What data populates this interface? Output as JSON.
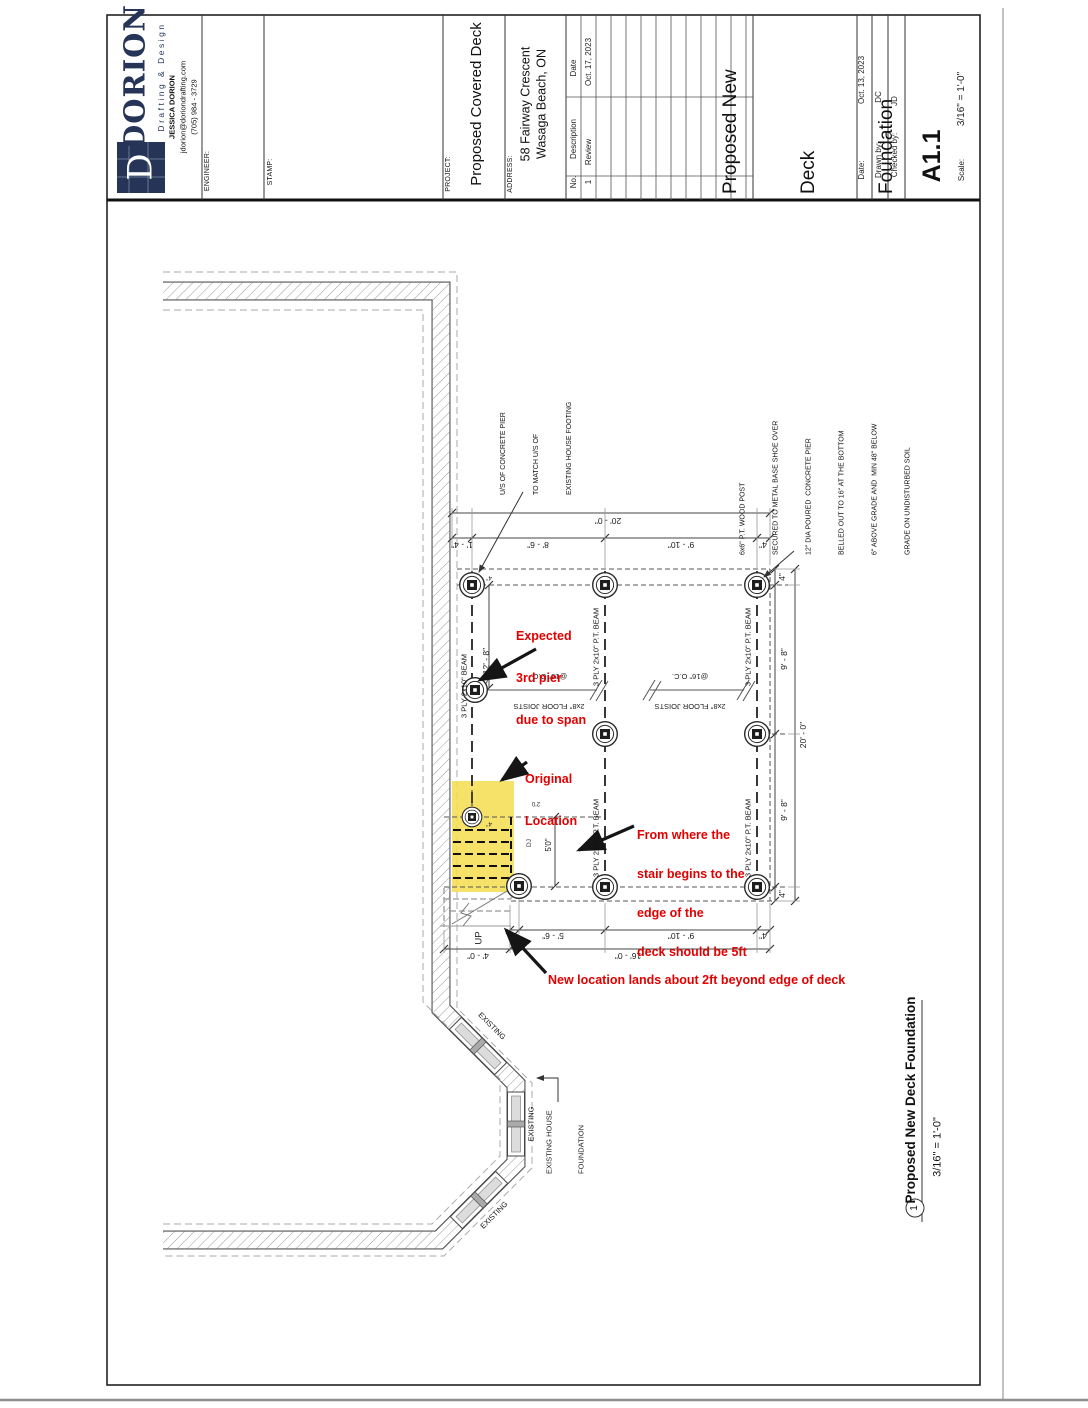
{
  "colors": {
    "navy": "#253457",
    "red": "#e20000",
    "highlight": "#f6dd4f"
  },
  "title_block": {
    "brand": {
      "name": "DORION",
      "tagline": "Drafting & Design",
      "contact_name": "JESSICA DORION",
      "email": "jdorion@doriondrafting.com",
      "phone": "(705) 984 - 3729",
      "logo_letter": "D"
    },
    "engineer_label": "ENGINEER:",
    "stamp_label": "STAMP:",
    "project_label": "PROJECT:",
    "project_name": "Proposed Covered Deck",
    "address_label": "ADDRESS:",
    "address_line1": "58 Fairway Crescent",
    "address_line2": "Wasaga Beach, ON",
    "revisions": {
      "no_label": "No.",
      "description_label": "Description",
      "date_label": "Date",
      "rows": [
        {
          "no": "1",
          "description": "Review",
          "date": "Oct. 17, 2023"
        }
      ]
    },
    "sheet_title_lines": [
      "Proposed New",
      "Deck",
      "Foundation"
    ],
    "date_label": "Date:",
    "date_value": "Oct. 13, 2023",
    "drawn_label": "Drawn by:",
    "drawn_value": "DC",
    "checked_label": "Checked by:",
    "checked_value": "JD",
    "sheet_number": "A1.1",
    "scale_label": "Scale:",
    "scale_value": "3/16\" = 1'-0\""
  },
  "viewport": {
    "number": "1",
    "title": "Proposed New Deck Foundation",
    "scale": "3/16\" = 1'-0\""
  },
  "plan": {
    "notes": {
      "pier_note_lines": [
        "U/S OF CONCRETE PIER",
        "TO MATCH U/S OF",
        "EXISTING HOUSE FOOTING"
      ],
      "post_note_lines": [
        "6x6\" P.T. WOOD POST",
        "SECURED TO METAL BASE SHOE OVER",
        "12\" DIA POURED  CONCRETE PIER",
        "BELLED OUT TO 16\" AT THE BOTTOM",
        "6\" ABOVE GRADE AND  MIN 48\" BELOW",
        "GRADE ON UNDISTURBED SOIL"
      ]
    },
    "labels": {
      "beam_left": "3 PLY 2x10\" BEAM",
      "beam": "3 PLY 2x10\" P.T. BEAM",
      "joists_line1": "2x8\" FLOOR JOISTS",
      "joists_line2": "@16\" O.C.",
      "up": "UP",
      "existing": "EXISTING",
      "existing_foundation_line1": "EXISTING HOUSE",
      "existing_foundation_line2": "FOUNDATION",
      "dj": "DJ",
      "stair_small": "2'0"
    },
    "dims": {
      "top_overall": "20' - 0\"",
      "top_segs": [
        "1' - 4\"",
        "8' - 6\"",
        "9' - 10\"",
        "4\""
      ],
      "right_overall": "20' - 0\"",
      "right_segs": [
        "4\"",
        "9' - 8\"",
        "9' - 8\"",
        "4\""
      ],
      "bottom_segs": [
        "4\"",
        "5' - 6\"",
        "9' - 10\"",
        "4\""
      ],
      "bottom_row2": [
        "4' - 0\"",
        "16' - 0\""
      ],
      "beam_left": "12' - 8\"",
      "stair": "5'0\"",
      "pier_offset": "4\""
    },
    "annotations": {
      "a1_lines": [
        "Expected",
        "3rd pier",
        "due to span"
      ],
      "a2_lines": [
        "Original",
        "Location"
      ],
      "a3_lines": [
        "From where the",
        "stair begins to the",
        "edge of the",
        "deck should be 5ft"
      ],
      "a4": "New location lands about 2ft beyond edge of deck"
    }
  }
}
